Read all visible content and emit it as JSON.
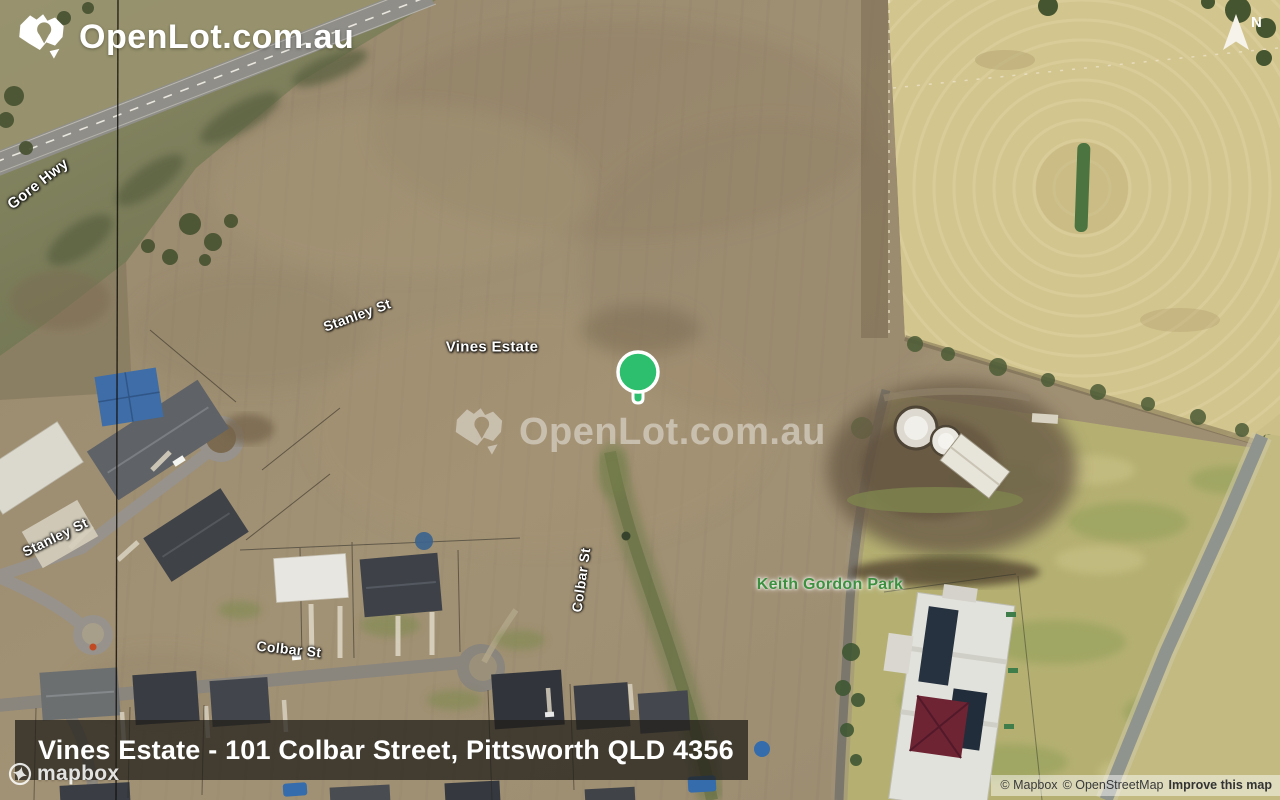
{
  "branding": {
    "logo_text": "OpenLot.com.au",
    "watermark_text": "OpenLot.com.au"
  },
  "compass": {
    "north_label": "N"
  },
  "map_labels": {
    "gore_hwy": "Gore Hwy",
    "stanley_st_upper": "Stanley St",
    "vines_estate": "Vines Estate",
    "stanley_st_lower": "Stanley St",
    "colbar_st_vertical": "Colbar St",
    "colbar_st_horizontal": "Colbar St",
    "keith_gordon_park": "Keith Gordon Park"
  },
  "marker": {
    "color": "#2ebf6e"
  },
  "banner": {
    "title": "Vines Estate - 101 Colbar Street, Pittsworth QLD 4356"
  },
  "attribution": {
    "mapbox_wordmark": "mapbox",
    "copyright_mapbox": "© Mapbox",
    "copyright_osm": "© OpenStreetMap",
    "improve_link": "Improve this map"
  },
  "colors": {
    "park_label_green": "#3c9140",
    "marker_green": "#2ebf6e",
    "banner_background": "rgba(34,31,26,0.74)"
  }
}
